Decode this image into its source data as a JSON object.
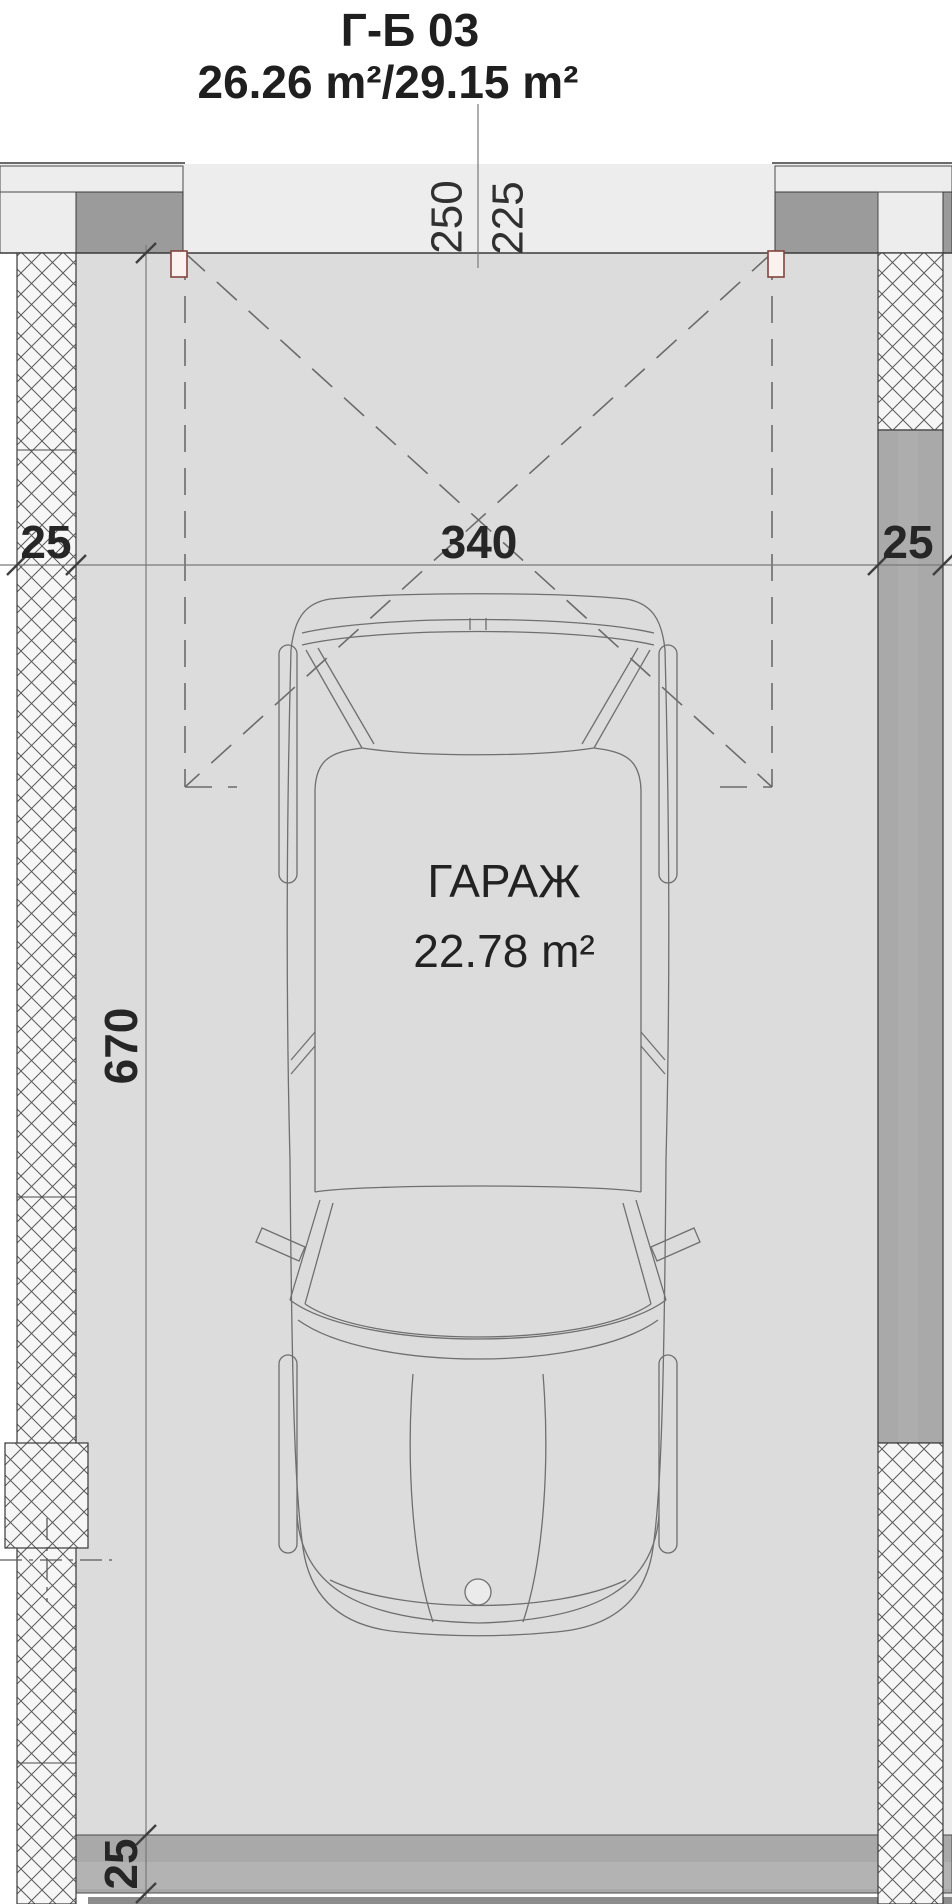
{
  "plan": {
    "title": "Г-Б 03",
    "area_summary": "26.26 m²/29.15 m²",
    "room": {
      "name": "ГАРАЖ",
      "area": "22.78 m²"
    },
    "dimensions": {
      "top_left_value": "250",
      "top_right_value": "225",
      "left_wall_thickness": "25",
      "opening_width": "340",
      "right_wall_thickness": "25",
      "interior_depth": "670",
      "rear_wall_thickness": "25"
    },
    "colors": {
      "apron": "#ededed",
      "floor": "#dcdcdc",
      "wall_solid": "#a9a9a9",
      "pier": "#9b9b9b",
      "car_fill": "#ebebeb",
      "hatch_bg": "#f6f6f6",
      "jamb_stroke": "#82453c",
      "outline": "#3a3a3a"
    }
  }
}
